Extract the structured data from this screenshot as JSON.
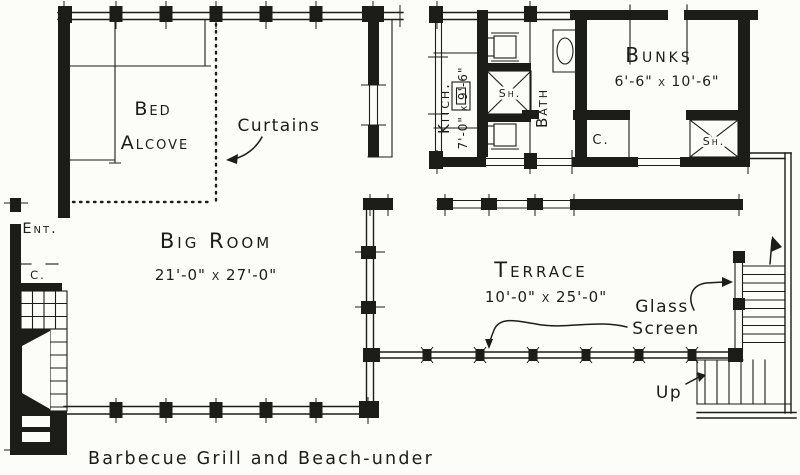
{
  "colors": {
    "ink": "#1c1c18",
    "paper": "#fcfcf8"
  },
  "rooms": {
    "bed_alcove": {
      "label_line1": "Bed",
      "label_line2": "Alcove"
    },
    "big_room": {
      "label": "Big Room",
      "dims": "21'-0\" x 27'-0\""
    },
    "kitchen": {
      "label": "Kitch.",
      "dims": "7'-0\" x 9'-6\""
    },
    "bath": {
      "label": "Bath"
    },
    "bunks": {
      "label": "Bunks",
      "dims": "6'-6\" x 10'-6\""
    },
    "terrace": {
      "label": "Terrace",
      "dims": "10'-0\" x 25'-0\""
    },
    "entry": {
      "label": "Ent."
    },
    "entry_closet": {
      "label": "C."
    },
    "bunks_closet": {
      "label": "C."
    },
    "bath_shower": {
      "label": "Sh."
    },
    "bunks_shower": {
      "label": "Sh."
    }
  },
  "annotations": {
    "curtains": "Curtains",
    "glass_screen_line1": "Glass",
    "glass_screen_line2": "Screen",
    "stairs_up": "Up",
    "caption": "Barbecue Grill and Beach-under"
  }
}
